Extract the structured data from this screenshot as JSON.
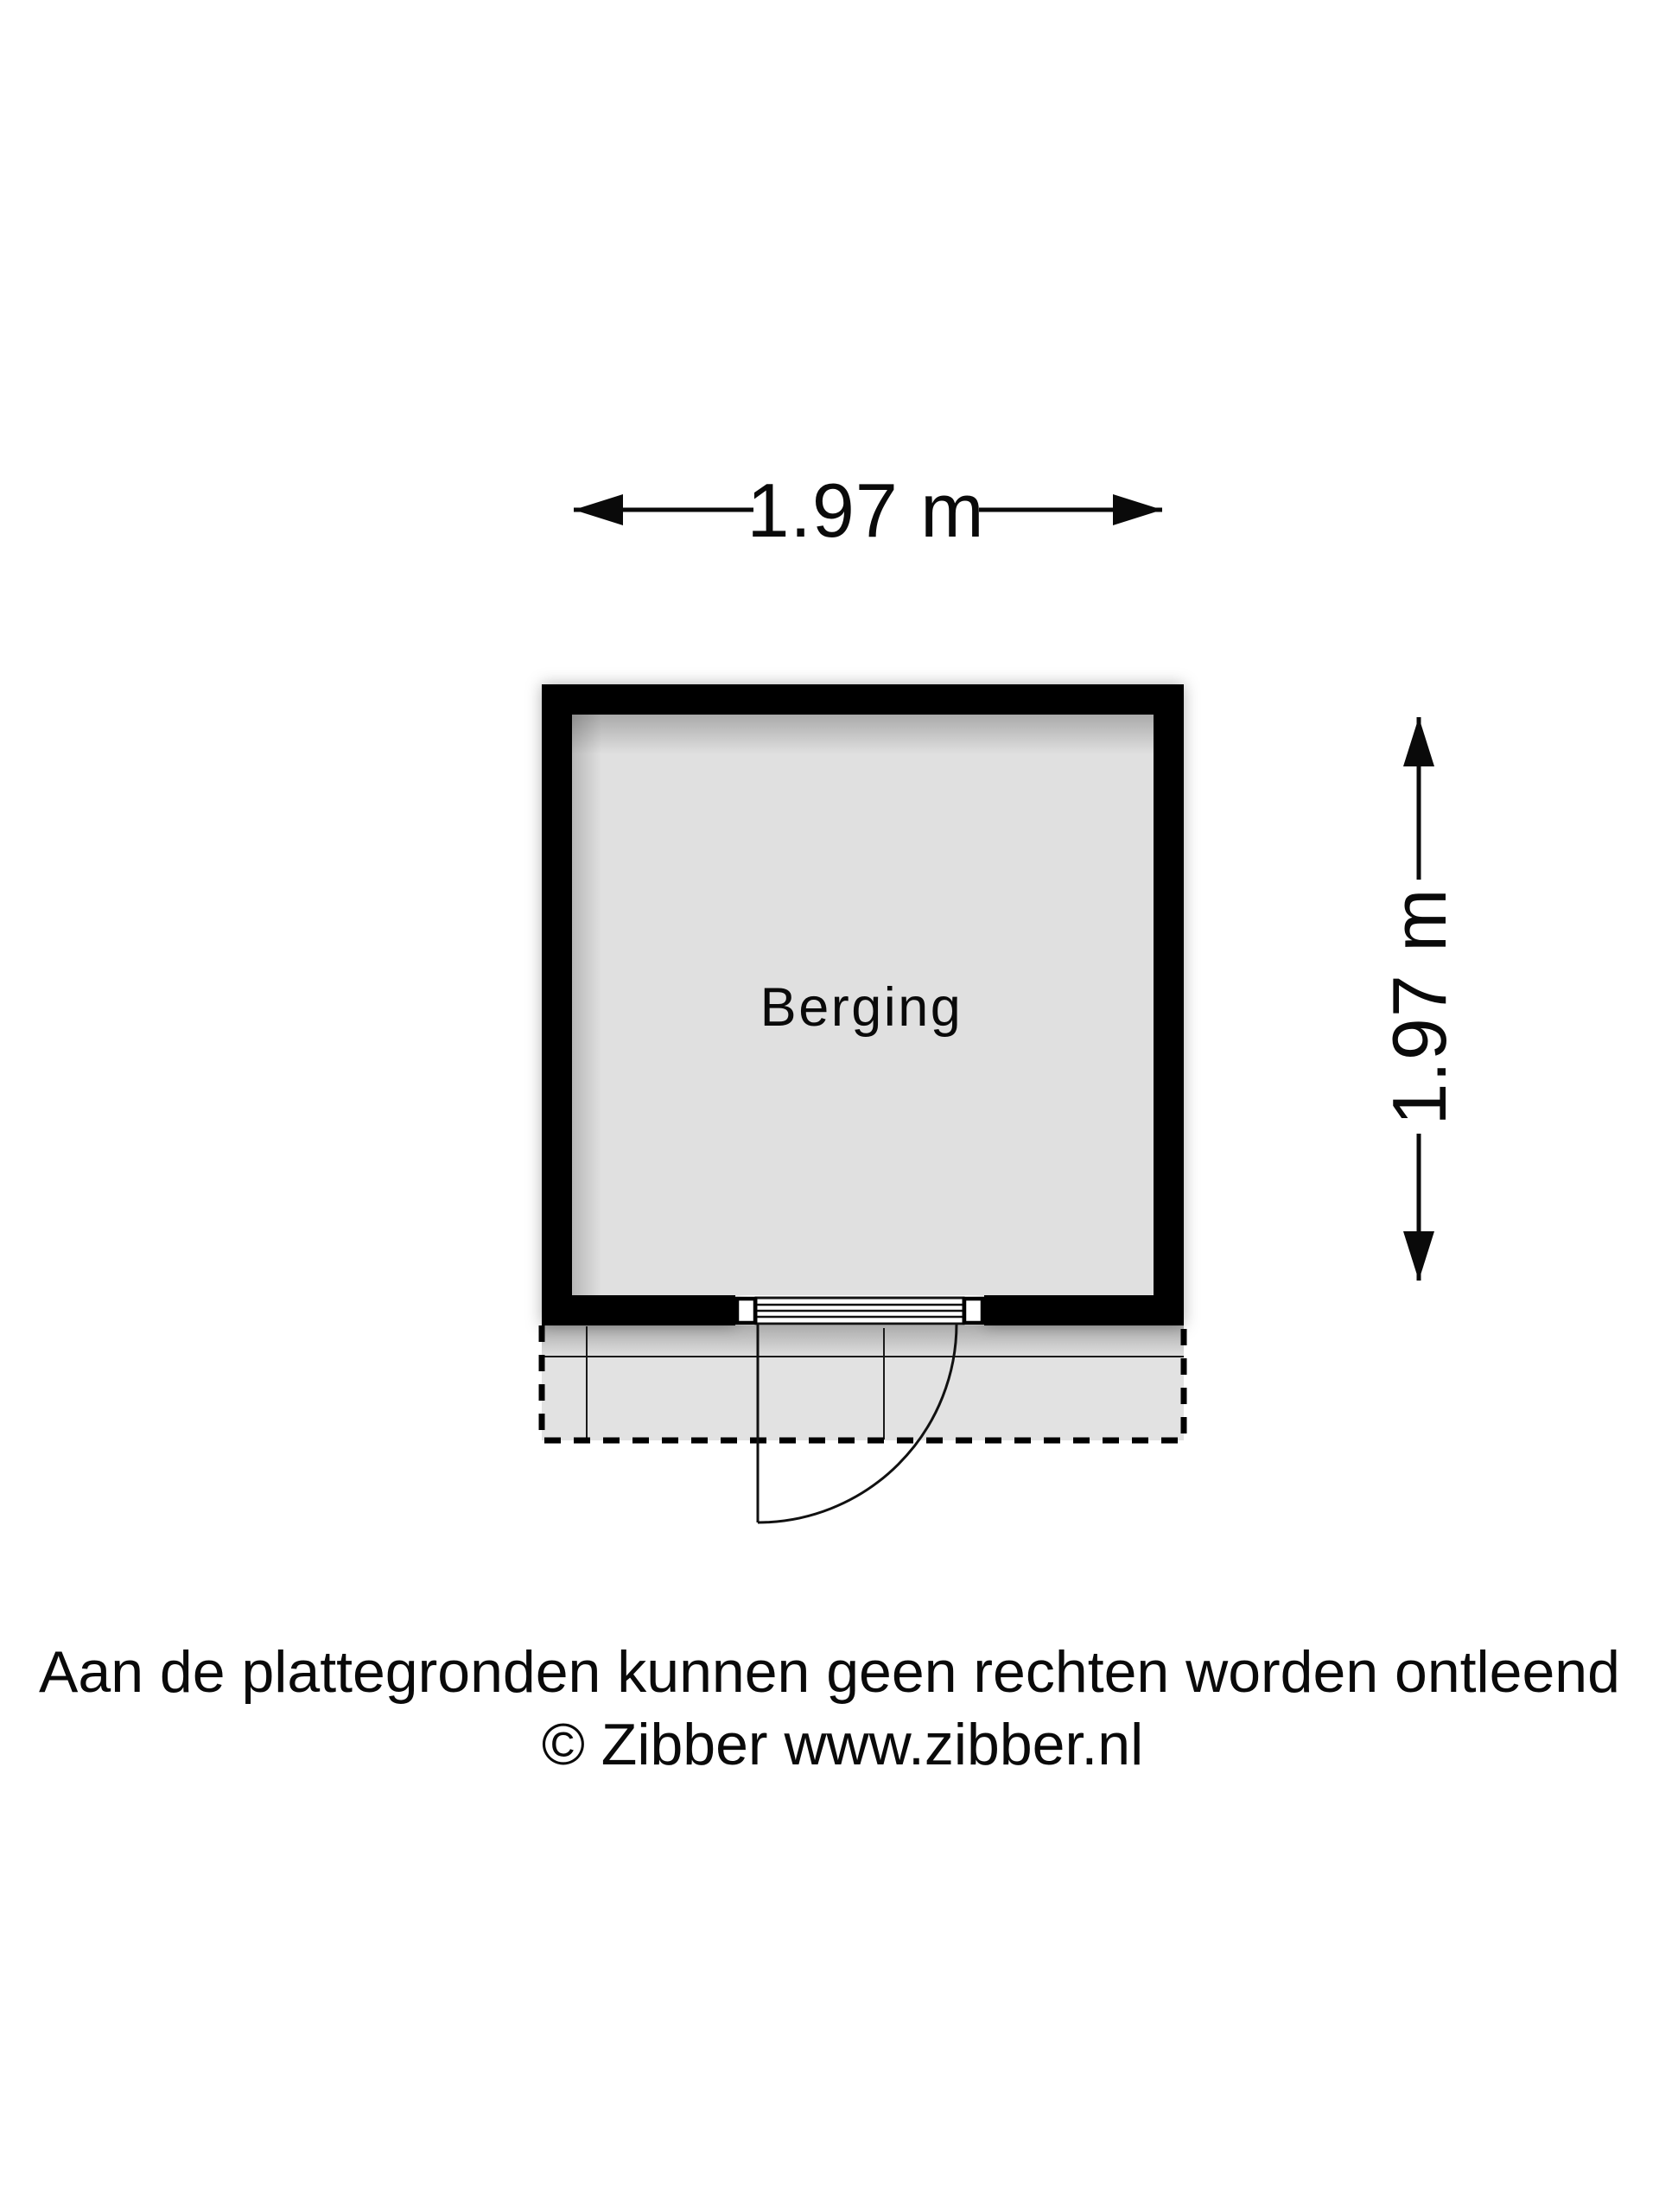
{
  "floorplan": {
    "room_label": "Berging",
    "dimension_top": "1.97 m",
    "dimension_right": "1.97 m"
  },
  "footer": {
    "disclaimer": "Aan de plattegronden kunnen geen rechten worden ontleend",
    "copyright": "© Zibber www.zibber.nl"
  },
  "colors": {
    "wall": "#000000",
    "room_fill": "#e0e0e0",
    "terrace_fill": "#e2e2e2",
    "line": "#0a0a0a",
    "background": "#ffffff",
    "text": "#0a0a0a"
  }
}
